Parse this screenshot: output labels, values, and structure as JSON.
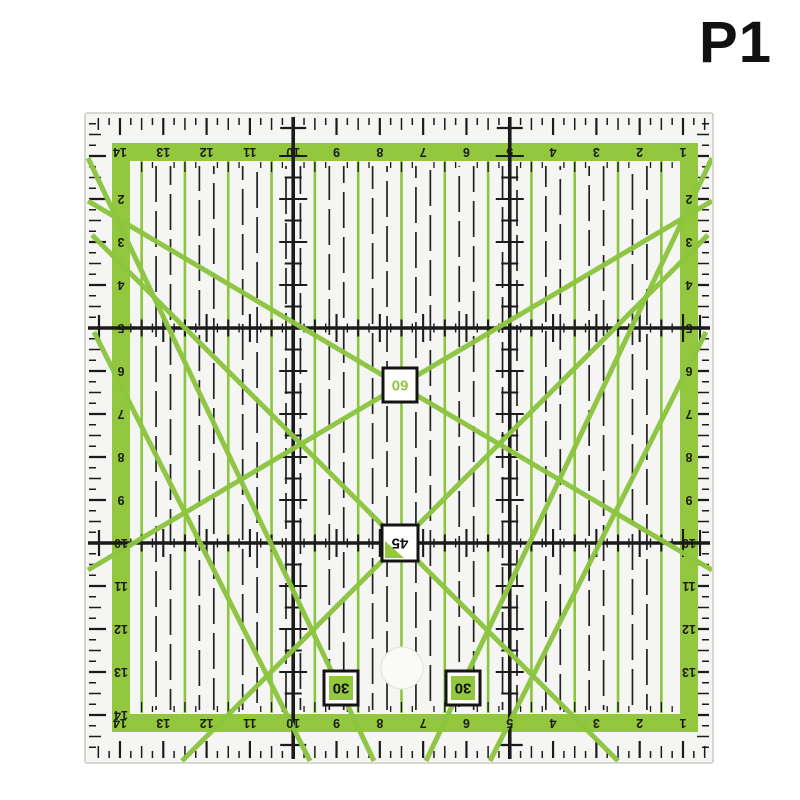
{
  "page": {
    "label": "P1",
    "background": "#ffffff"
  },
  "ruler": {
    "type": "quilting-patchwork-ruler",
    "unit_count": 14,
    "angle_labels": {
      "sixty": "60",
      "fortyfive": "45",
      "thirty_left": "30",
      "thirty_right": "30"
    },
    "scales": {
      "top": [
        "14",
        "13",
        "12",
        "11",
        "10",
        "9",
        "8",
        "7",
        "6",
        "5",
        "4",
        "3",
        "2",
        "1"
      ],
      "bottom": [
        "14",
        "13",
        "12",
        "11",
        "10",
        "9",
        "8",
        "7",
        "6",
        "5",
        "4",
        "3",
        "2",
        "1"
      ],
      "left": [
        "2",
        "3",
        "4",
        "5",
        "6",
        "7",
        "8",
        "9",
        "10",
        "11",
        "12",
        "13",
        "14"
      ],
      "right": [
        "2",
        "3",
        "4",
        "5",
        "6",
        "7",
        "8",
        "9",
        "10",
        "11",
        "12",
        "13"
      ]
    },
    "colors": {
      "band_green": "#93c73d",
      "line_green": "#8cc53f",
      "marking": "#1b1b1b",
      "body": "#f5f5f3",
      "edge": "#cccbc6",
      "box_bg": "#ffffff",
      "box_border": "#141414",
      "hole_fill": "#fafaf8",
      "hole_edge": "#e4e4e0"
    }
  }
}
